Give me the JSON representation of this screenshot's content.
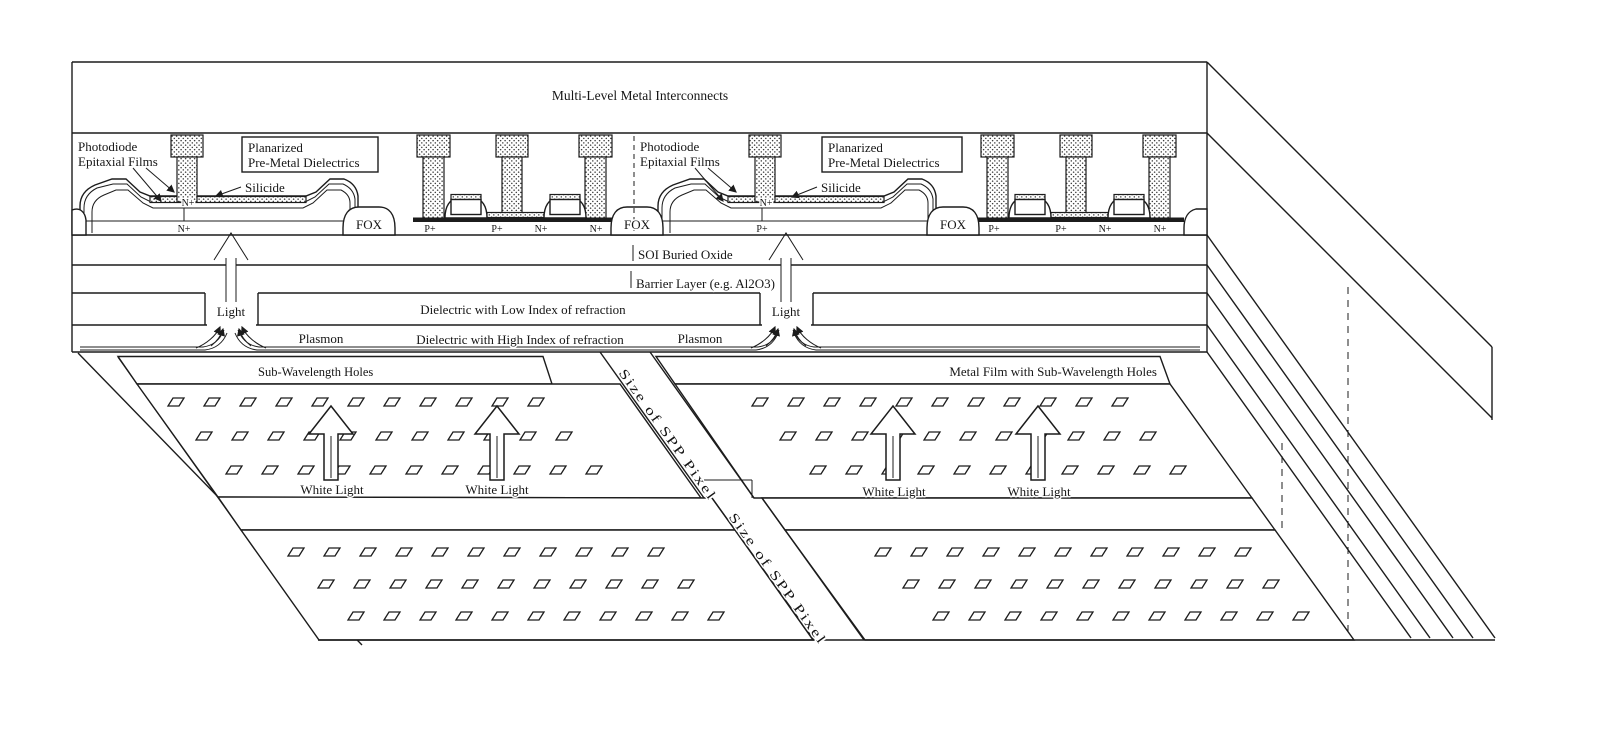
{
  "diagram": {
    "top": "Multi-Level Metal Interconnects",
    "photodiode_line1": "Photodiode",
    "photodiode_line2": "Epitaxial Films",
    "planarized_line1": "Planarized",
    "planarized_line2": "Pre-Metal Dielectrics",
    "silicide": "Silicide",
    "fox": "FOX",
    "n_plus": "N+",
    "p_plus": "P+",
    "soi": "SOI Buried Oxide",
    "barrier": "Barrier Layer (e.g. Al2O3)",
    "low_index": "Dielectric with Low Index of refraction",
    "high_index": "Dielectric with High Index of refraction",
    "plasmon": "Plasmon",
    "light": "Light",
    "sub_wavelength": "Sub-Wavelength Holes",
    "metal_film": "Metal Film with Sub-Wavelength Holes",
    "spp_pixel": "Size of SPP Pixel",
    "white_light": "White Light",
    "ink_color": "#1c1c1c",
    "paper_color": "#ffffff"
  }
}
